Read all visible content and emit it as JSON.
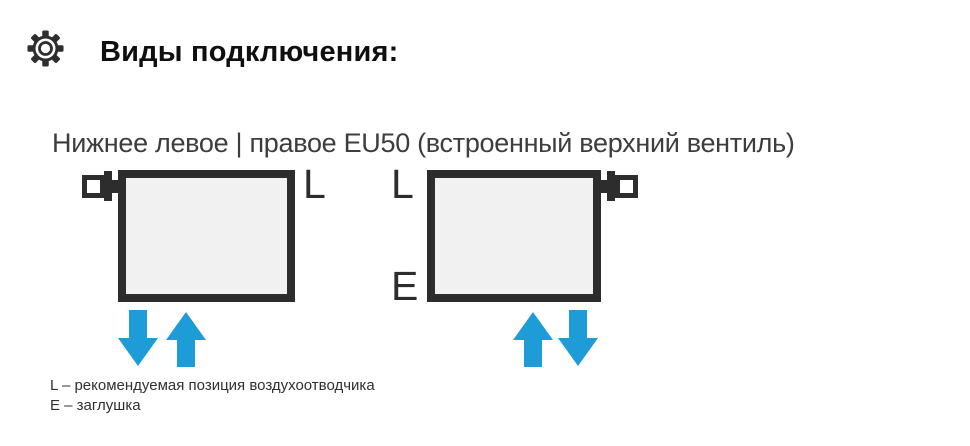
{
  "header": {
    "icon": "gear-icon",
    "title": "Виды подключения:"
  },
  "connection": {
    "title": "Нижнее левое | правое EU50 (встроенный верхний вентиль)",
    "diagrams": [
      {
        "name": "нижнее левое подключение",
        "valve_side": "left",
        "air_vent_label": "L",
        "arrows": [
          "down",
          "up"
        ]
      },
      {
        "name": "нижнее правое подключение",
        "valve_side": "right",
        "air_vent_label": "L",
        "plug_label": "E",
        "arrows": [
          "up",
          "down"
        ]
      }
    ]
  },
  "legend": {
    "lines": [
      "L – рекомендуемая позиция воздухоотводчика",
      "E – заглушка"
    ]
  },
  "colors": {
    "arrow_blue": "#1e9cd7",
    "outline_dark": "#2d2d2d",
    "radiator_fill": "#f1f1f1",
    "title_text": "#0f0f0f",
    "subtitle_text": "#3d3d3d"
  }
}
